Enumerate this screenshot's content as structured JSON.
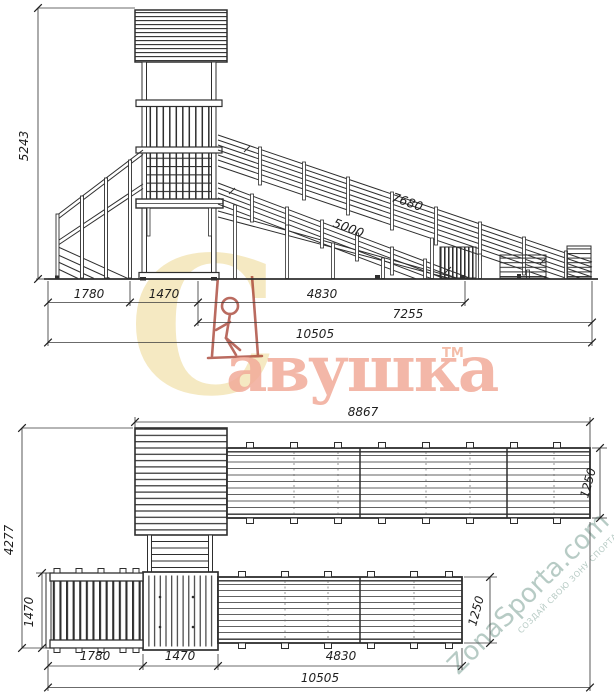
{
  "title": "playground-tower-slide-technical-drawing",
  "watermarks": {
    "savushka": {
      "letter_c": "С",
      "rest": "авушка",
      "tm": "ТМ"
    },
    "zonasporta": {
      "brand": "ZonaSporta.com",
      "slogan": "СОЗДАЙ СВОЮ ЗОНУ СПОРТА"
    }
  },
  "colors": {
    "line": "#2e2e2e",
    "savushka_c": "#f5e9c2",
    "savushka_text": "#f2ab99",
    "savushka_figure": "#a43a2b",
    "zonasporta": "#b4c9c2"
  },
  "elevation": {
    "dims": {
      "height_total": "5243",
      "slope_outer": "7680",
      "slope_inner": "5000",
      "seg_stairs": "1780",
      "seg_tower": "1470",
      "seg_ramp": "4830",
      "ramp_span": "7255",
      "total_span": "10505"
    }
  },
  "plan": {
    "dims": {
      "top_span": "8867",
      "height_total": "4277",
      "platform_depth": "1470",
      "bridge_width": "1250",
      "ramp_width": "1250",
      "seg_platform": "1780",
      "seg_tower": "1470",
      "seg_ramp": "4830",
      "total_span": "10505"
    }
  }
}
